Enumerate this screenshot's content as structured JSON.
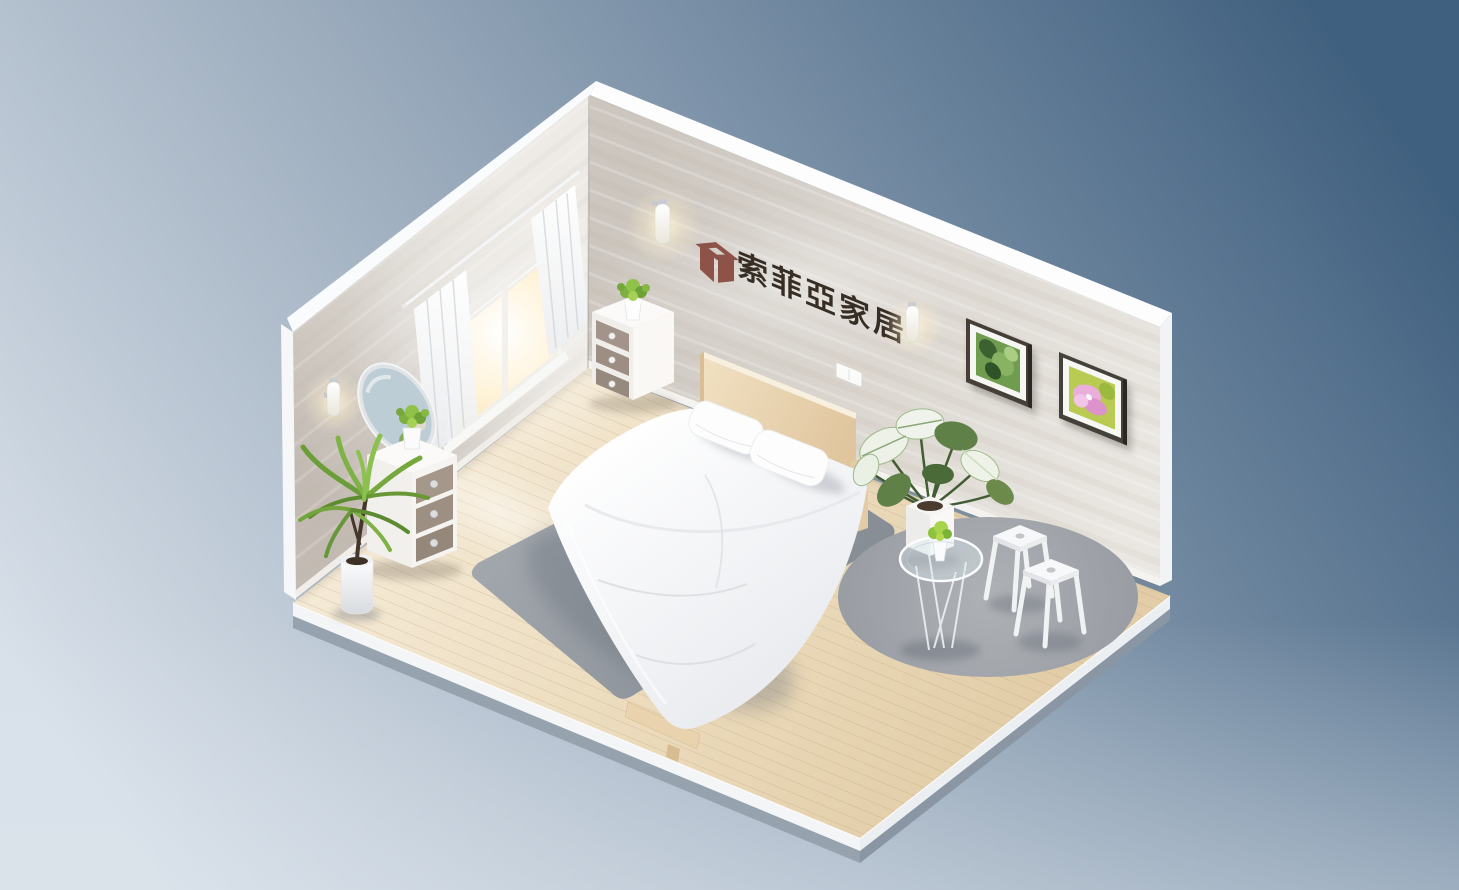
{
  "scene": {
    "label": "isometric bedroom showroom 3d render",
    "objects": [
      "double bed with white duvet and two pillows",
      "light wood headboard",
      "three-drawer nightstand with small potted plant",
      "three-drawer dresser with small potted plant",
      "round wall mirror",
      "window with sheer white curtains and warm light",
      "tall potted palm plant",
      "variegated monstera plant in white cube pot",
      "round glass side table with small plant",
      "two white metal stools",
      "rectangular gray rug under bed",
      "round gray rug",
      "framed green foliage picture",
      "framed pink flower picture",
      "three glowing wall sconce lamps",
      "white light switch panel",
      "brand sign with cube logo on wall",
      "wood plank floor platform on blue gradient backdrop"
    ]
  },
  "wall_sign": {
    "text": "索菲亞家居",
    "logo_icon": "open-box-cube-logo",
    "text_color": "#362d24",
    "logo_color": "#8d5248"
  },
  "palette": {
    "background_top_right": "#40607f",
    "background_bottom_left": "#d8e0e9",
    "floor_wood": "#ecdcc0",
    "plank_line": "#b89a74",
    "wall_plaster_light": "#eeebe6",
    "wall_plaster_shadow": "#c3bbb3",
    "rug_gray": "#9aa0a6",
    "round_rug_gray": "#a8abaf",
    "duvet_white": "#ffffff",
    "headboard_wood": "#ead9b7",
    "drawer_taupe": "#9d9083",
    "leaf_green": "#76a83d",
    "slab_edge_white": "#f3f5f7",
    "slab_edge_gray": "#97a2af"
  }
}
